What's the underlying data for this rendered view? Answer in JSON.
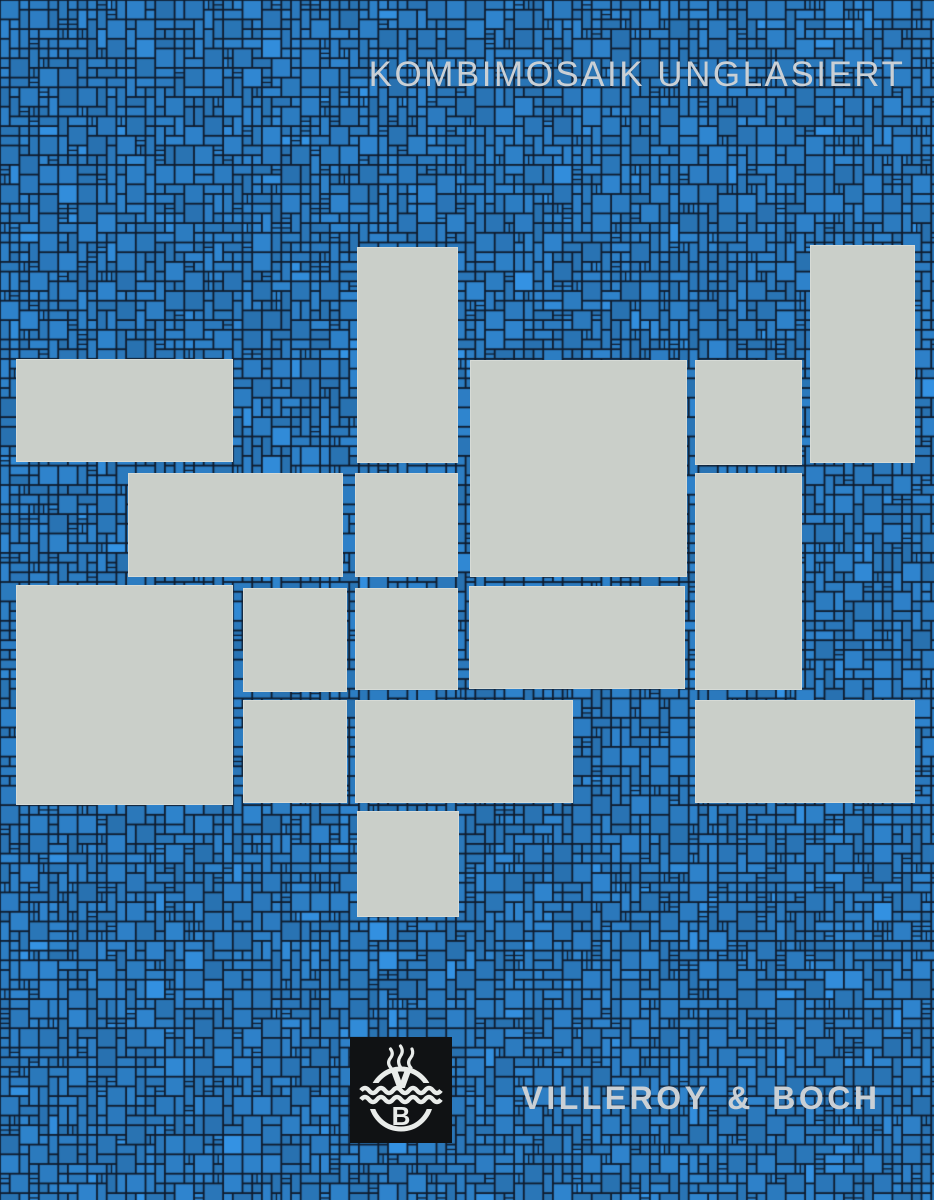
{
  "poster": {
    "title": "KOMBIMOSAIK UNGLASIERT",
    "brand": "VILLEROY & BOCH",
    "logo": {
      "icon": "villeroy-boch-well-emblem",
      "monogram_top": "V",
      "monogram_bottom": "B"
    }
  },
  "colors": {
    "tile_blue": "#2c7bbf",
    "tile_blue_light": "#3f8ccd",
    "grout_dark": "#0f1c2e",
    "sheet_gray": "#cacfc9",
    "title_gray": "#cad0d5",
    "logo_black": "#101214",
    "emblem_white": "#e9ecea"
  },
  "mosaic": {
    "unit_px": 9.7,
    "grout_px": 1.8,
    "seed": 1973
  },
  "composition": {
    "canvas_w": 934,
    "canvas_h": 1200,
    "sheets": [
      {
        "x": 357,
        "y": 247,
        "w": 101,
        "h": 216
      },
      {
        "x": 810,
        "y": 245,
        "w": 105,
        "h": 218
      },
      {
        "x": 16,
        "y": 359,
        "w": 217,
        "h": 103
      },
      {
        "x": 470,
        "y": 360,
        "w": 217,
        "h": 217
      },
      {
        "x": 695,
        "y": 360,
        "w": 107,
        "h": 105
      },
      {
        "x": 128,
        "y": 473,
        "w": 215,
        "h": 104
      },
      {
        "x": 355,
        "y": 473,
        "w": 103,
        "h": 104
      },
      {
        "x": 695,
        "y": 473,
        "w": 107,
        "h": 217
      },
      {
        "x": 16,
        "y": 585,
        "w": 217,
        "h": 220
      },
      {
        "x": 243,
        "y": 588,
        "w": 104,
        "h": 104
      },
      {
        "x": 355,
        "y": 588,
        "w": 103,
        "h": 102
      },
      {
        "x": 469,
        "y": 586,
        "w": 216,
        "h": 103
      },
      {
        "x": 243,
        "y": 700,
        "w": 104,
        "h": 103
      },
      {
        "x": 355,
        "y": 700,
        "w": 218,
        "h": 103
      },
      {
        "x": 695,
        "y": 700,
        "w": 220,
        "h": 103
      },
      {
        "x": 357,
        "y": 811,
        "w": 102,
        "h": 106
      }
    ]
  }
}
